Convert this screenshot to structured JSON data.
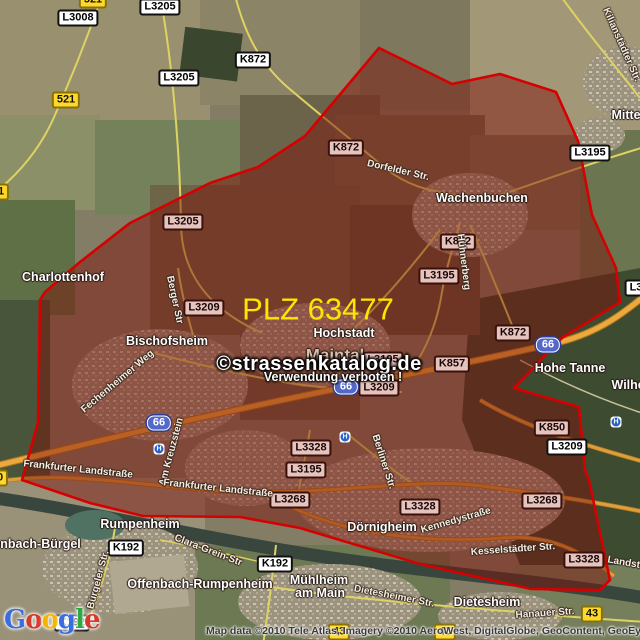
{
  "map": {
    "plz_label": "PLZ 63477",
    "watermark": {
      "line1": "©strassenkatalog.de",
      "line2": "Verwendung verboten !"
    },
    "attribution": "Map data ©2010 Tele Atlas, Imagery ©2010 AeroWest, DigitalGlobe, GeoContent, GeoEye",
    "bus_stop_glyph": "H",
    "logo": {
      "letters": [
        {
          "ch": "G",
          "color": "#3b6ce0"
        },
        {
          "ch": "o",
          "color": "#d33a2c"
        },
        {
          "ch": "o",
          "color": "#f3b600"
        },
        {
          "ch": "g",
          "color": "#3b6ce0"
        },
        {
          "ch": "l",
          "color": "#2fa743"
        },
        {
          "ch": "e",
          "color": "#d33a2c"
        }
      ]
    },
    "colors": {
      "boundary_stroke": "#d60000",
      "boundary_fill": "#7d0f08",
      "plz_text": "#ffe400",
      "motorway_badge_bg": "#5468c8",
      "road_badge_bg": "#ffffff",
      "road_badge_tinted_bg": "#e6c3bd",
      "yellow_badge_bg": "#ffd92a"
    },
    "badges_white": [
      "L3008",
      "L3205",
      "K872",
      "L3205",
      "L3195",
      "K192",
      "K192",
      "K192",
      "L3209",
      "L3"
    ],
    "badges_tinted": [
      "L3205",
      "K872",
      "K872",
      "L3195",
      "L3209",
      "L3195",
      "L3209",
      "K857",
      "K872",
      "K850",
      "L3328",
      "L3195",
      "L3268",
      "L3328",
      "L3268",
      "L3328"
    ],
    "badges_yellow": [
      "521",
      "521",
      "1",
      "0",
      "43",
      "43",
      "43"
    ],
    "badges_motorway": [
      "66",
      "66",
      "66"
    ],
    "towns": [
      "Charlottenhof",
      "Wachenbuchen",
      "Hochstadt",
      "Maintal",
      "Bischofsheim",
      "Hohe Tanne",
      "Dörnigheim",
      "Rumpenheim",
      "Offenbach-Bürgel",
      "Offenbach-Rumpenheim",
      "Mühlheim",
      "am Main",
      "Dietesheim",
      "Mittelbuchen",
      "Wilhelmsbad"
    ],
    "streets": [
      "Dorfelder Str.",
      "Kilianstädter Str.",
      "Hühnerberg",
      "Berger Str",
      "Fechenheimer Weg",
      "Am Kreuzstein",
      "Frankfurter Landstraße",
      "Frankfurter Landstraße",
      "Berliner Str.",
      "Kennedystraße",
      "Kesselstädter Str.",
      "Clara-Grein-Str",
      "Bürgeler Str.",
      "Dietesheimer Str.",
      "Hanauer Str.",
      "Landstraße"
    ]
  }
}
